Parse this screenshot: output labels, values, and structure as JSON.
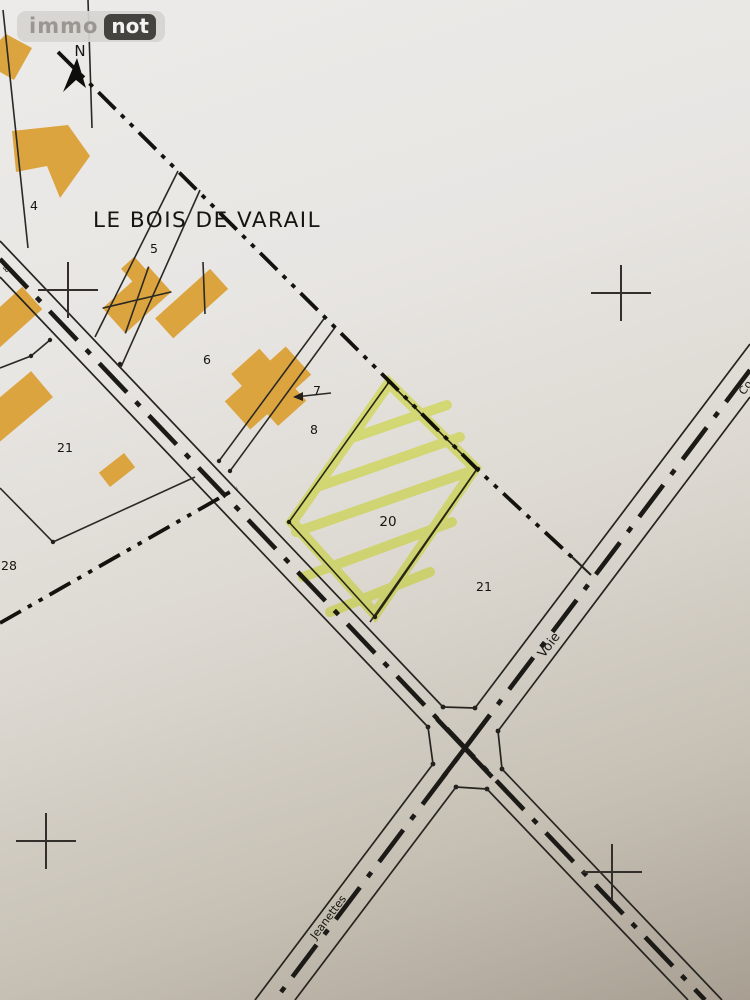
{
  "brand": {
    "immo": "immo",
    "not": "not"
  },
  "map": {
    "area_name": "LE BOIS DE VARAIL",
    "north_label": "N",
    "highlighted_parcel": "20",
    "parcels": {
      "p4": "4",
      "p5": "5",
      "p6": "6",
      "p7": "7",
      "p8": "8",
      "p20": "20",
      "p21_left": "21",
      "p21_right": "21",
      "p28": "28",
      "tiny8": "8"
    },
    "streets": {
      "voie": "Voie",
      "jeanettes": "Jeanettes",
      "edge_partial": "Co"
    },
    "colors": {
      "building": "#dca43e",
      "highlight": "#e8f55e",
      "line": "#26241f",
      "paper_top": "#edebe9",
      "paper_bottom": "#a89f92"
    }
  }
}
